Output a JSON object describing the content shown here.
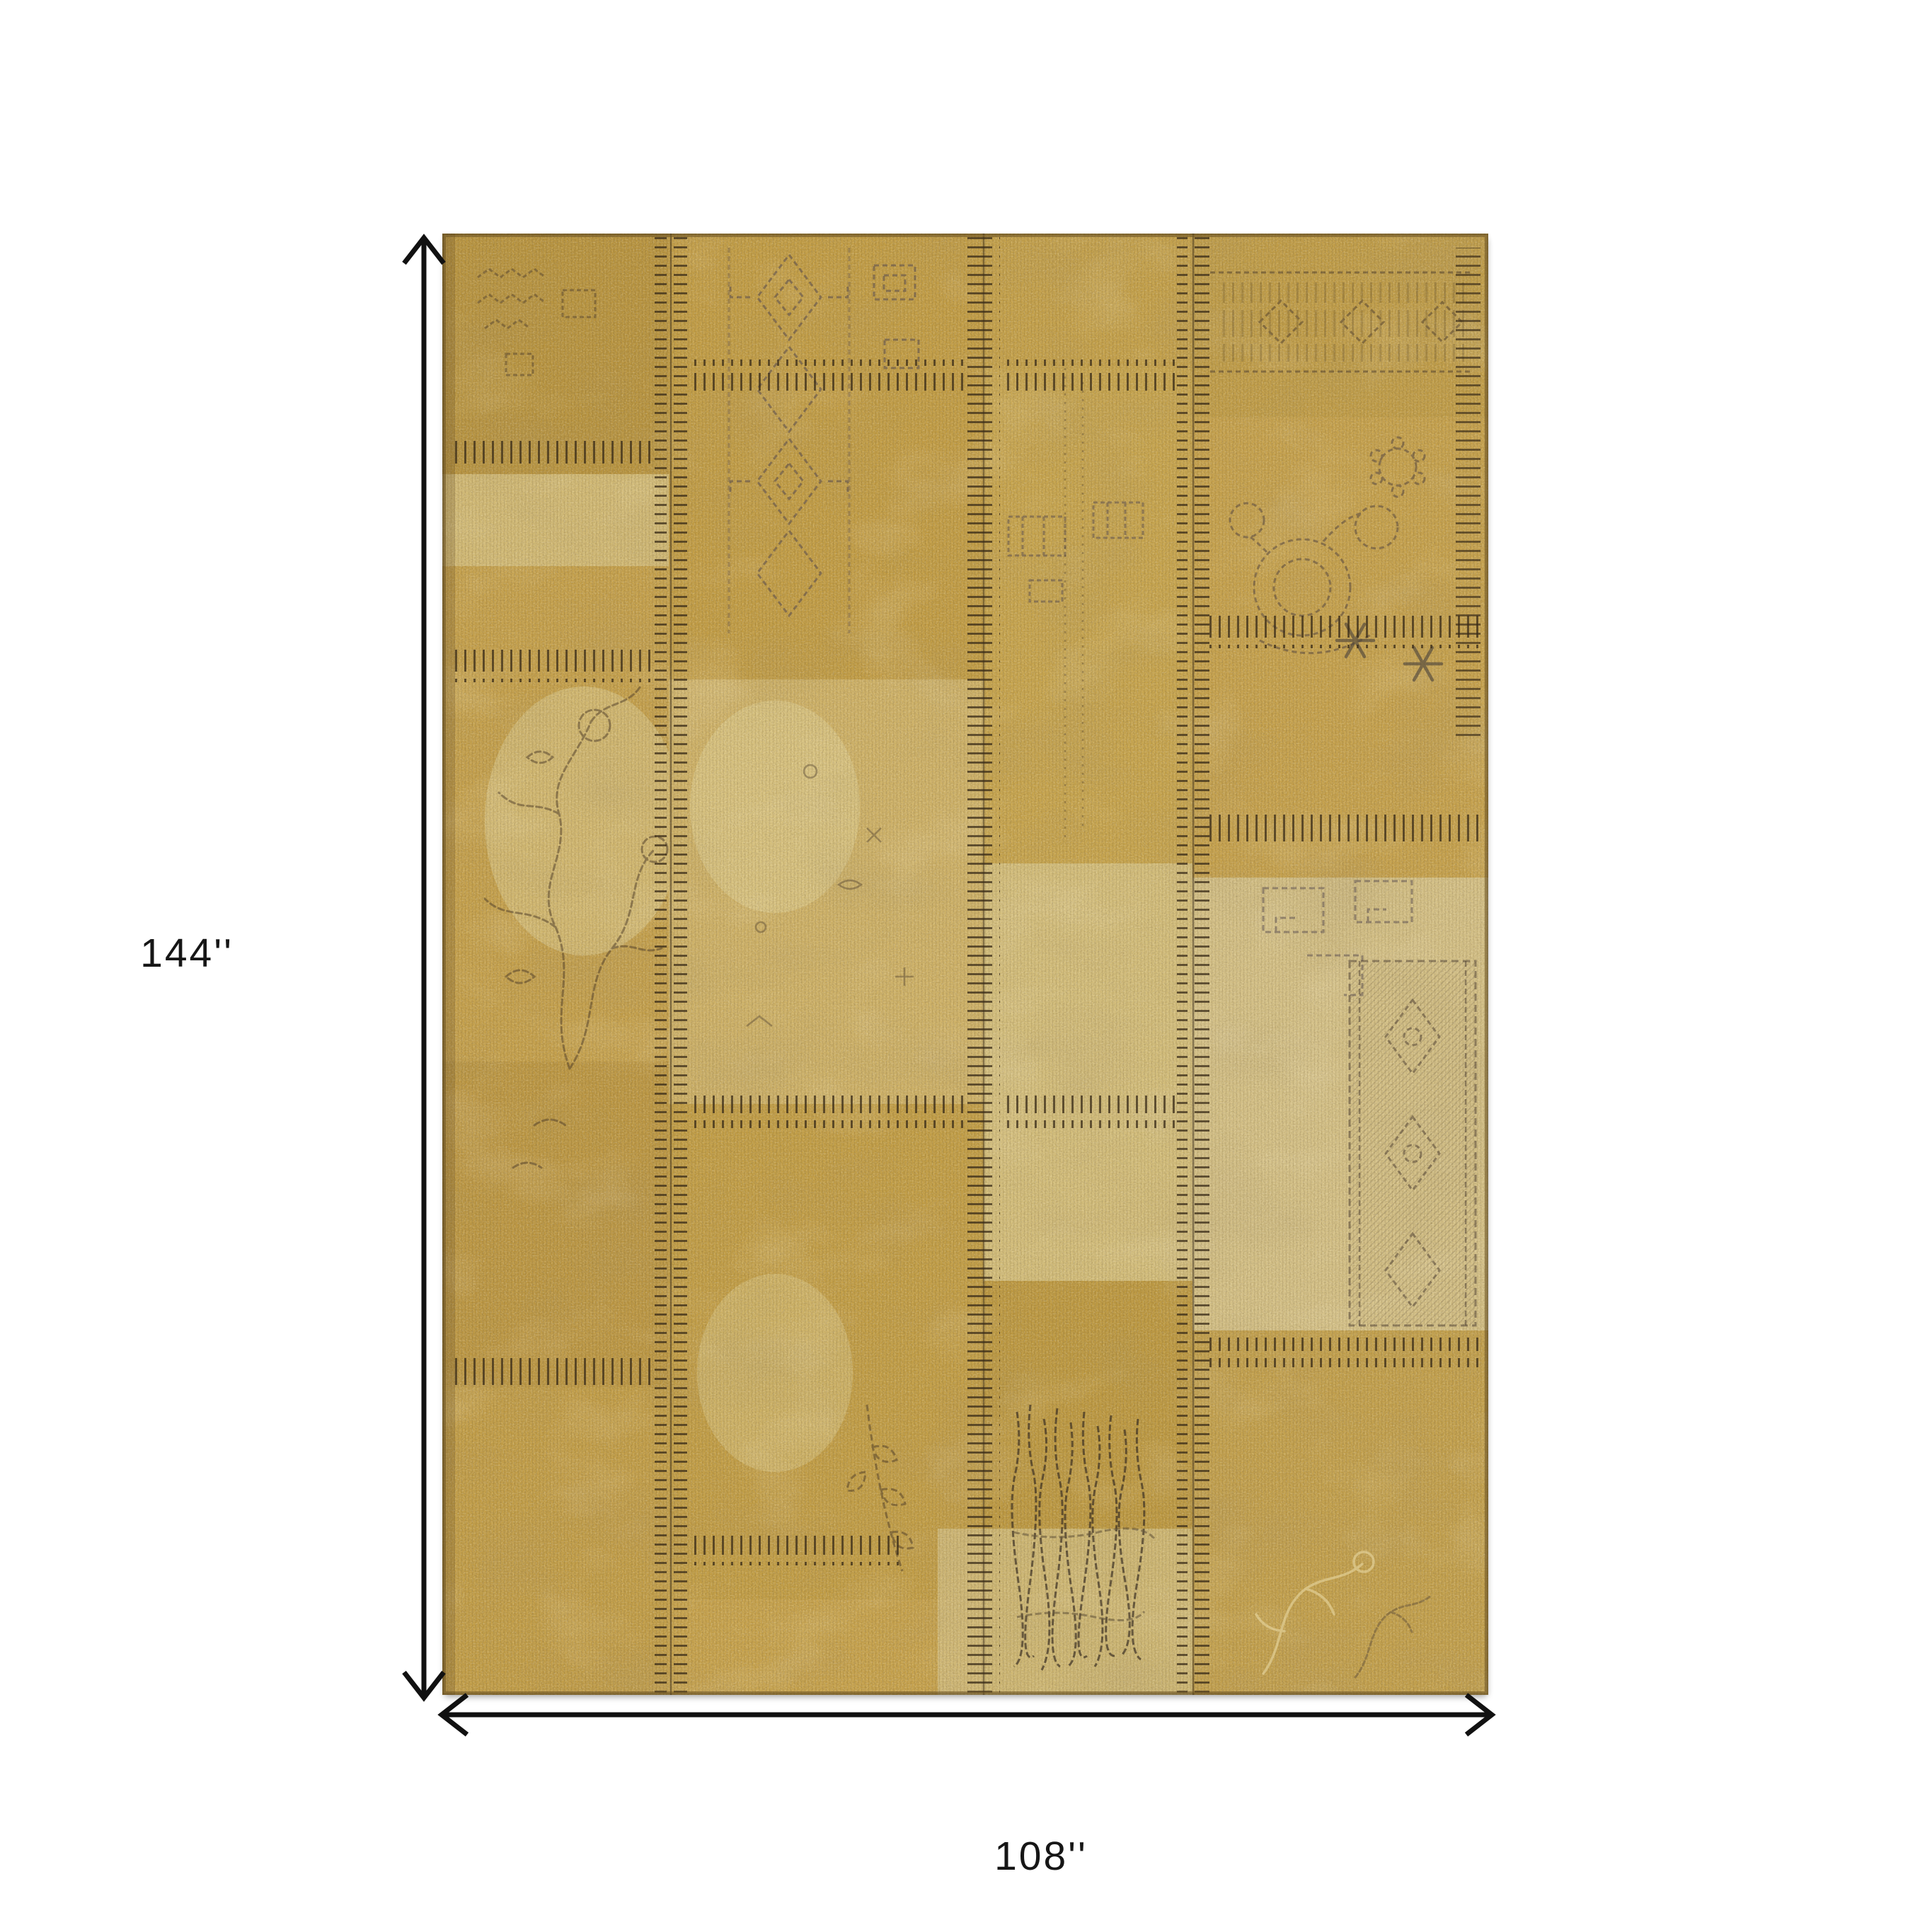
{
  "diagram": {
    "type": "product-dimension-diagram",
    "product": "distressed gold patchwork area rug",
    "height_label": "144''",
    "width_label": "108''",
    "arrow_color": "#111111",
    "label_color": "#161616",
    "background_color": "#ffffff"
  },
  "rug": {
    "base_color": "#c49f46",
    "dark_patch_color": "#b8933c",
    "light_patch_color": "#d5c084",
    "pale_patch_color": "#dbc88f",
    "stitch_color": "#3a2c18",
    "motif_dark_color": "#4b3b2c",
    "motif_violet_color": "#564a4e",
    "edge_color": "#6e5524"
  }
}
